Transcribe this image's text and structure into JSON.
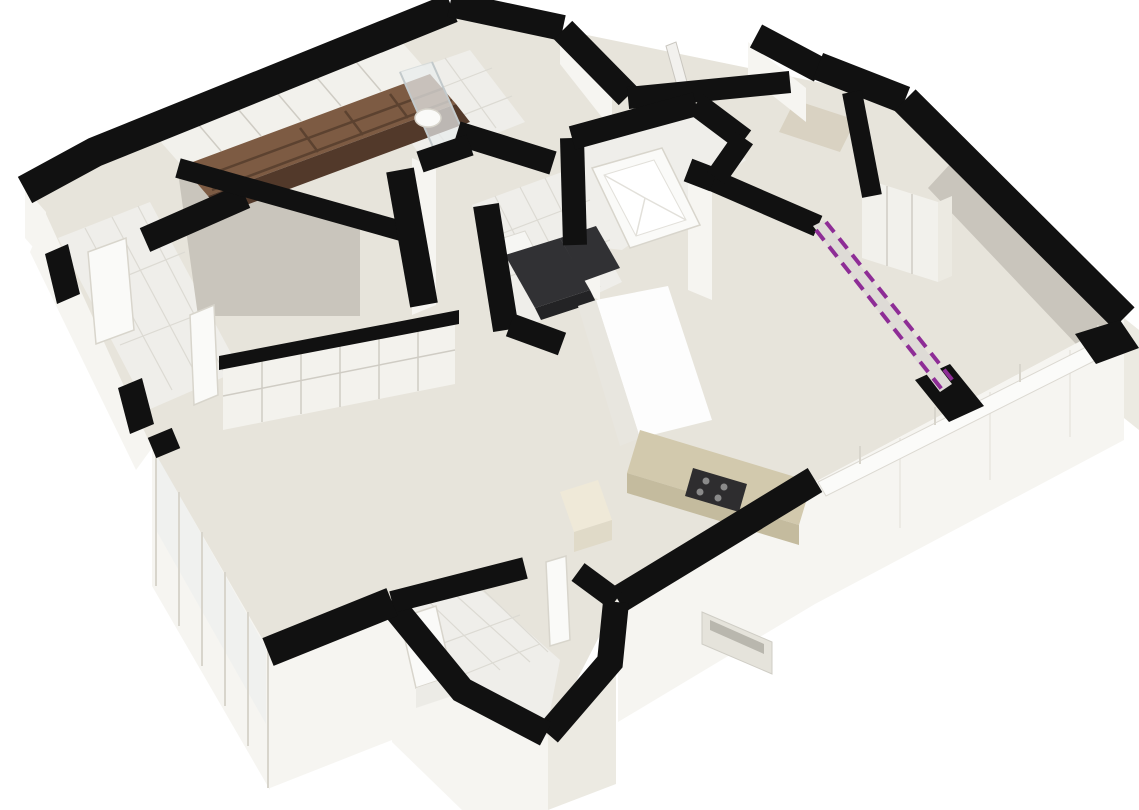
{
  "scene": {
    "kind": "3d-floor-plan-cutaway-render",
    "view": "axonometric-birds-eye",
    "text_visible": "none",
    "canvas": {
      "width": 1139,
      "height": 810
    }
  },
  "colors": {
    "bg": "#ffffff",
    "wall_cut": "#111111",
    "wall_face": "#f6f5f1",
    "wall_face_shadow": "#eceae2",
    "wall_face_dark": "#c9c5bc",
    "floor_wood": "#e7e4db",
    "floor_tile": "#efeeea",
    "tile_line": "#dcdad3",
    "glass": "#e9edee",
    "frame_line": "#d8d5cc",
    "wardrobe_brown": "#7d5b43",
    "wardrobe_brown_dark": "#52392a",
    "cabinet_white": "#f2f1ec",
    "cabinet_line": "#cfccc4",
    "counter_beige": "#d2c9ad",
    "counter_beige_dark": "#c4bb9e",
    "stove_dark": "#2e2d2f",
    "burner_gray": "#8a8a8a",
    "sofa_dark": "#313134",
    "annotation_purple": "#8e2d96",
    "annotation_wall": "#dedbd6"
  },
  "rooms": [
    {
      "id": "wardrobe-room",
      "position": "top-left",
      "feature": "full-wall brown wardrobe with white doors and open shelves"
    },
    {
      "id": "shower-room",
      "position": "top-center-left",
      "feature": "glass shower enclosure, toilet"
    },
    {
      "id": "bathtub-room",
      "position": "top-center",
      "feature": "built-in white bathtub"
    },
    {
      "id": "small-dark-room",
      "position": "center-left",
      "feature": "dark L-shaped seat and white table"
    },
    {
      "id": "entry-corridor",
      "position": "west",
      "feature": "tiled floor, exterior door, interior open door"
    },
    {
      "id": "living-room",
      "position": "bottom-left",
      "feature": "wood floor, paneled closet wall, floor-to-ceiling window wall"
    },
    {
      "id": "hall",
      "position": "center",
      "feature": "wood floor connecting rooms"
    },
    {
      "id": "kitchen",
      "position": "bottom-center-right",
      "feature": "beige L-counter with gas cooktop, tall white column"
    },
    {
      "id": "lower-bathroom",
      "position": "bottom-center",
      "feature": "white vanity with sink, tiled floor, door leaf"
    },
    {
      "id": "bedroom-right",
      "position": "right",
      "feature": "sliding-door closet, window bays on southeast wall"
    },
    {
      "id": "top-niche",
      "position": "top-center",
      "feature": "recessed balcony niche with open door leaf"
    }
  ],
  "annotation": {
    "id": "marked-wall",
    "style": "double-dashed-line-on-low-wall",
    "meaning_hint": "wall highlighted on plan",
    "from_px": [
      816,
      228
    ],
    "to_px": [
      948,
      390
    ]
  },
  "fixtures": [
    {
      "id": "wardrobe-unit",
      "room": "wardrobe-room"
    },
    {
      "id": "shower-glass",
      "room": "shower-room"
    },
    {
      "id": "toilet",
      "room": "shower-room"
    },
    {
      "id": "bathtub",
      "room": "bathtub-room"
    },
    {
      "id": "corner-seat",
      "room": "small-dark-room"
    },
    {
      "id": "side-table",
      "room": "small-dark-room"
    },
    {
      "id": "kitchen-counter",
      "room": "kitchen"
    },
    {
      "id": "gas-cooktop",
      "room": "kitchen",
      "burners": 4
    },
    {
      "id": "kitchen-box-cabinet",
      "room": "kitchen"
    },
    {
      "id": "vanity-sink",
      "room": "lower-bathroom"
    },
    {
      "id": "sliding-closet",
      "room": "bedroom-right"
    },
    {
      "id": "window-wall",
      "room": "living-room",
      "panes": 6
    },
    {
      "id": "small-window",
      "room": "kitchen"
    },
    {
      "id": "entry-door",
      "room": "entry-corridor"
    },
    {
      "id": "open-door-leaves",
      "count": 3
    }
  ]
}
